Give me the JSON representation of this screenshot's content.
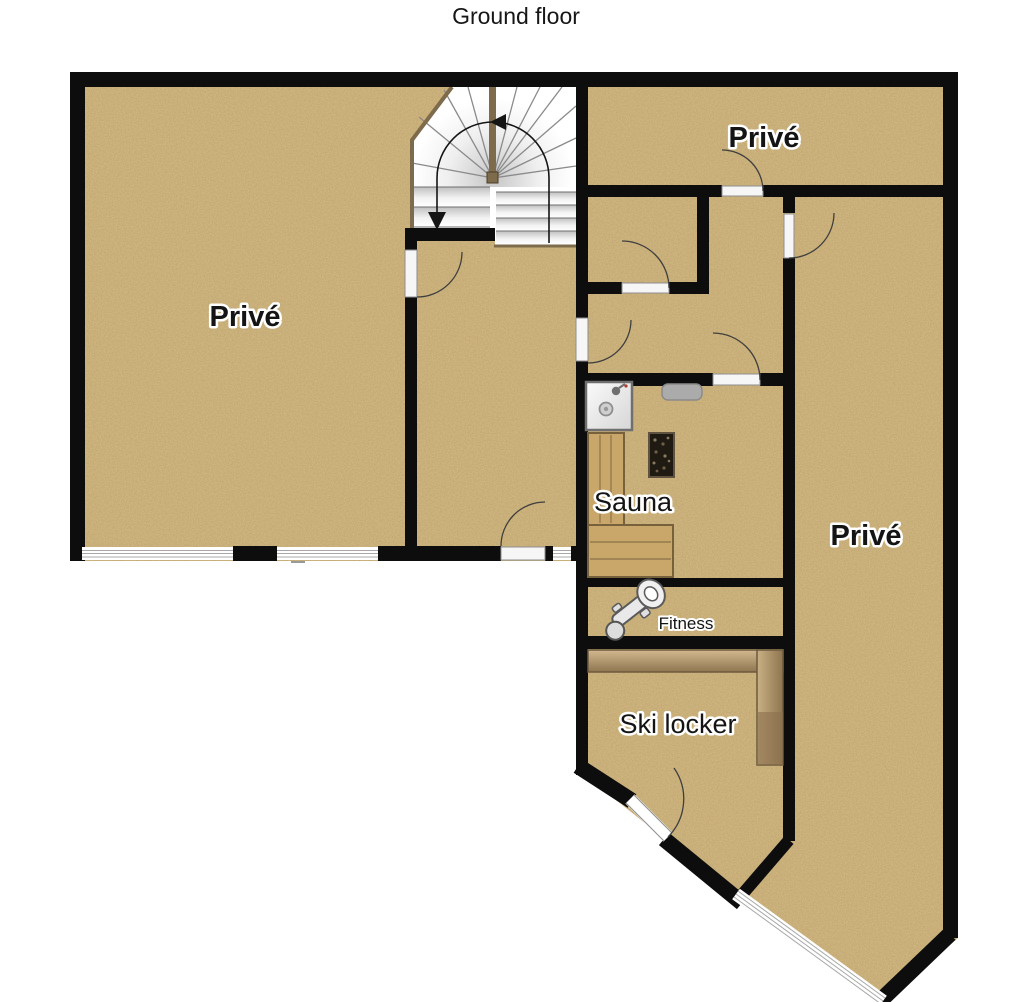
{
  "title": "Ground floor",
  "plan": {
    "rooms": [
      {
        "id": "prive-left",
        "label": "Privé",
        "bold": true
      },
      {
        "id": "prive-top-right",
        "label": "Privé",
        "bold": true
      },
      {
        "id": "prive-right",
        "label": "Privé",
        "bold": true
      },
      {
        "id": "sauna",
        "label": "Sauna",
        "bold": false
      },
      {
        "id": "fitness",
        "label": "Fitness",
        "bold": false
      },
      {
        "id": "ski-locker",
        "label": "Ski locker",
        "bold": false
      }
    ],
    "icons": [
      "staircase",
      "stair-direction-arrows",
      "door-swing-arc",
      "window",
      "shower-icon",
      "shower-drain-icon",
      "sauna-stove-icon",
      "sauna-bench",
      "wall-bench-icon",
      "exercise-bike-icon",
      "ski-counter"
    ],
    "colors": {
      "floor": "#d8bc85",
      "wall": "#0d0d0d",
      "bench_wood": "#c9a76b",
      "counter_wood": "#b0946a",
      "stair_wall": "#7d6b4c",
      "background": "#ffffff"
    }
  }
}
